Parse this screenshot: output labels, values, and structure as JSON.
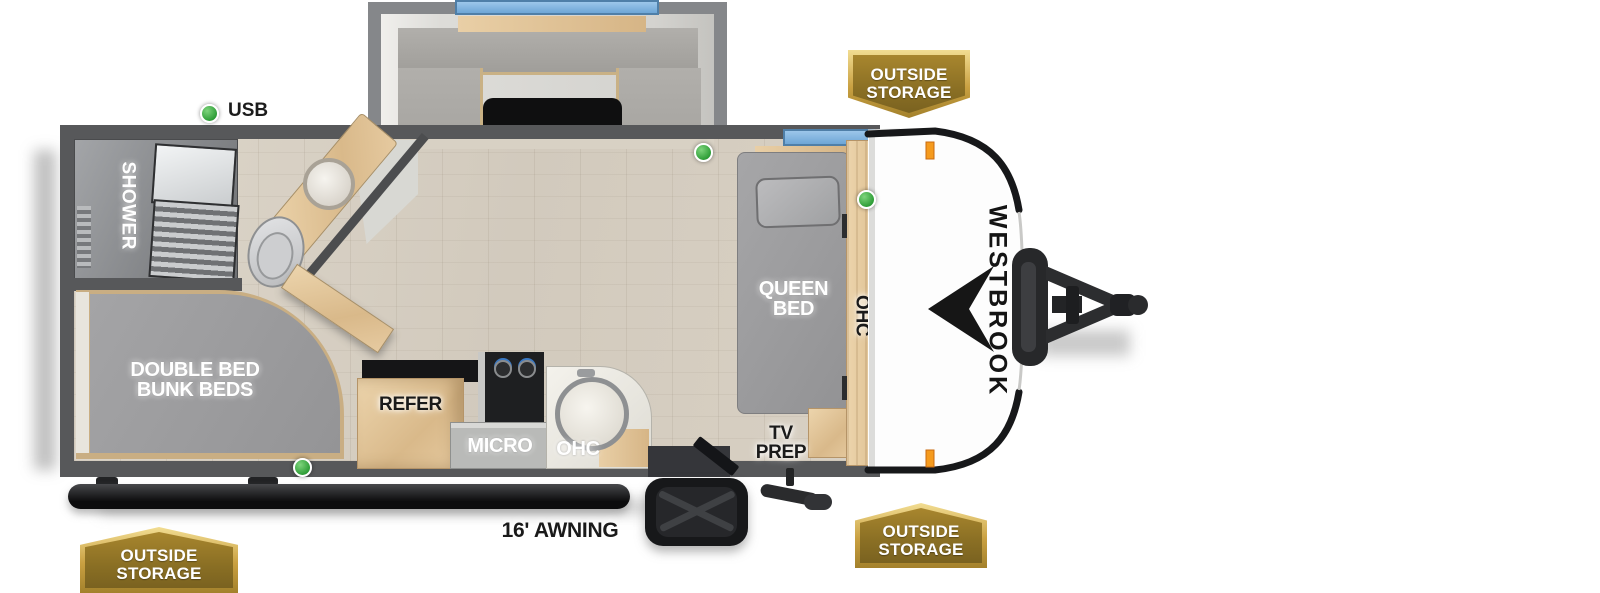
{
  "brand": {
    "name": "WESTBROOK"
  },
  "exterior": {
    "awning_label": "16' AWNING",
    "usb_label": "USB",
    "badges": [
      {
        "id": "front-top",
        "line1": "OUTSIDE",
        "line2": "STORAGE"
      },
      {
        "id": "front-bottom",
        "line1": "OUTSIDE",
        "line2": "STORAGE"
      },
      {
        "id": "rear-bottom",
        "line1": "OUTSIDE",
        "line2": "STORAGE"
      }
    ]
  },
  "rooms": {
    "dinette": "DINETTE",
    "shower": "SHOWER",
    "queen_bed_l1": "QUEEN",
    "queen_bed_l2": "BED",
    "bunk_l1": "DOUBLE BED",
    "bunk_l2": "BUNK BEDS",
    "refer": "REFER",
    "micro": "MICRO",
    "ohc_kitchen": "OHC",
    "ohc_bedroom": "OHC",
    "tv_l1": "TV",
    "tv_l2": "PREP"
  },
  "colors": {
    "wall": "#57585a",
    "floor_wood": "#d7cfc2",
    "badge_gold": "#8a6f24",
    "badge_border": "#e7c96f",
    "window_blue": "#7fb7e6",
    "green_led": "#3fae47",
    "bed_gray": "#9c9c9e",
    "cabinet_wood": "#e2c79f",
    "trim_black": "#17181a"
  }
}
